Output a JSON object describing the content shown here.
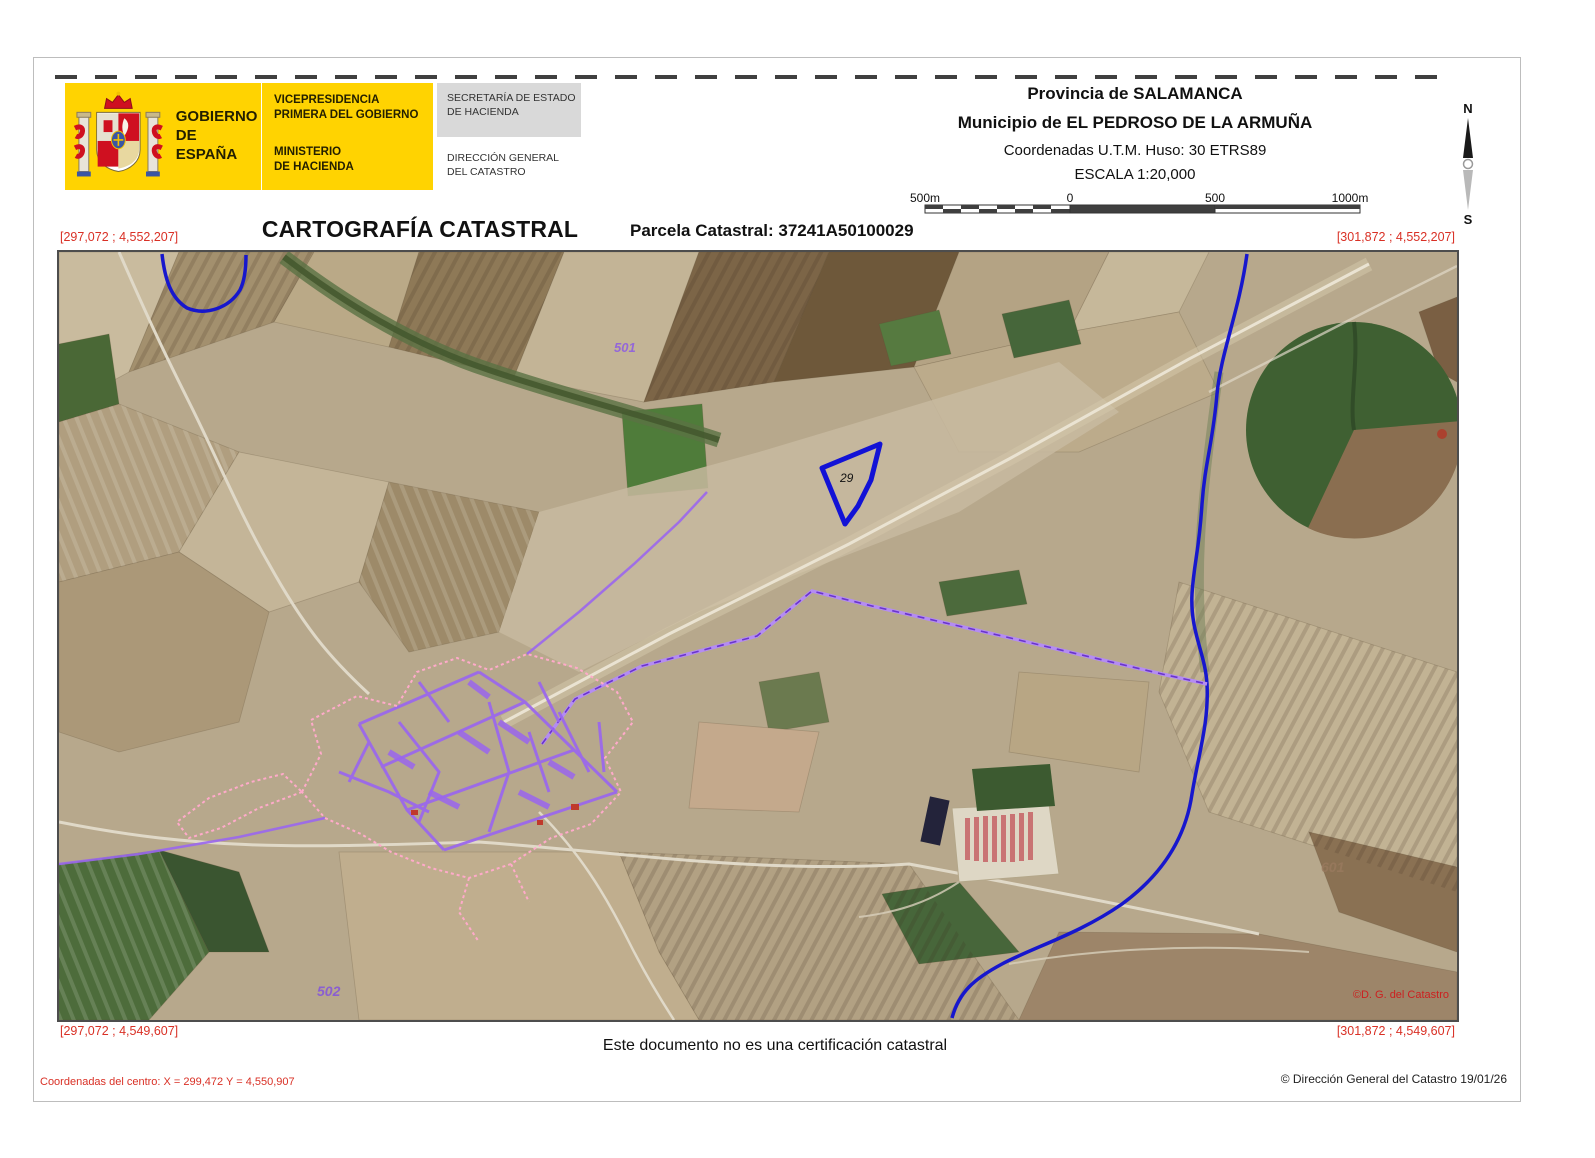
{
  "page": {
    "header": {
      "logo_text": [
        "GOBIERNO",
        "DE ESPAÑA"
      ],
      "dept_top": [
        "VICEPRESIDENCIA",
        "PRIMERA DEL GOBIERNO"
      ],
      "dept_bottom": [
        "MINISTERIO",
        "DE HACIENDA"
      ],
      "secretaria": [
        "SECRETARÍA DE ESTADO",
        "DE HACIENDA"
      ],
      "direccion": [
        "DIRECCIÓN GENERAL",
        "DEL CATASTRO"
      ]
    },
    "info": {
      "provincia": "Provincia de SALAMANCA",
      "municipio": "Municipio de EL PEDROSO DE LA ARMUÑA",
      "coordenadas": "Coordenadas U.T.M. Huso: 30 ETRS89",
      "escala": "ESCALA 1:20,000"
    },
    "scalebar": {
      "label_left": "500m",
      "label_zero": "0",
      "label_500": "500",
      "label_right": "1000m"
    },
    "compass": {
      "north": "N",
      "south": "S"
    },
    "title": "CARTOGRAFÍA CATASTRAL",
    "parcela": "Parcela Catastral: 37241A50100029",
    "map": {
      "corner_tl": "[297,072 ; 4,552,207]",
      "corner_tr": "[301,872 ; 4,552,207]",
      "corner_bl": "[297,072 ; 4,549,607]",
      "corner_br": "[301,872 ; 4,549,607]",
      "parcel_number": "29",
      "road_label_501": "501",
      "road_label_502": "502",
      "road_label_601": "601",
      "map_credit": "©D. G. del Catastro"
    },
    "footer": {
      "disclaimer": "Este documento no es una certificación catastral",
      "center_coords": "Coordenadas del centro: X = 299,472 Y = 4,550,907",
      "copyright": "© Dirección General del Catastro 19/01/26"
    },
    "colors": {
      "brand_yellow": "#ffd301",
      "coord_red": "#d93025",
      "cadastral_purple": "#9a66ee",
      "boundary_purple": "#6a35cc",
      "hydro_blue": "#1717cd",
      "parcel_blue": "#1212d6"
    }
  }
}
